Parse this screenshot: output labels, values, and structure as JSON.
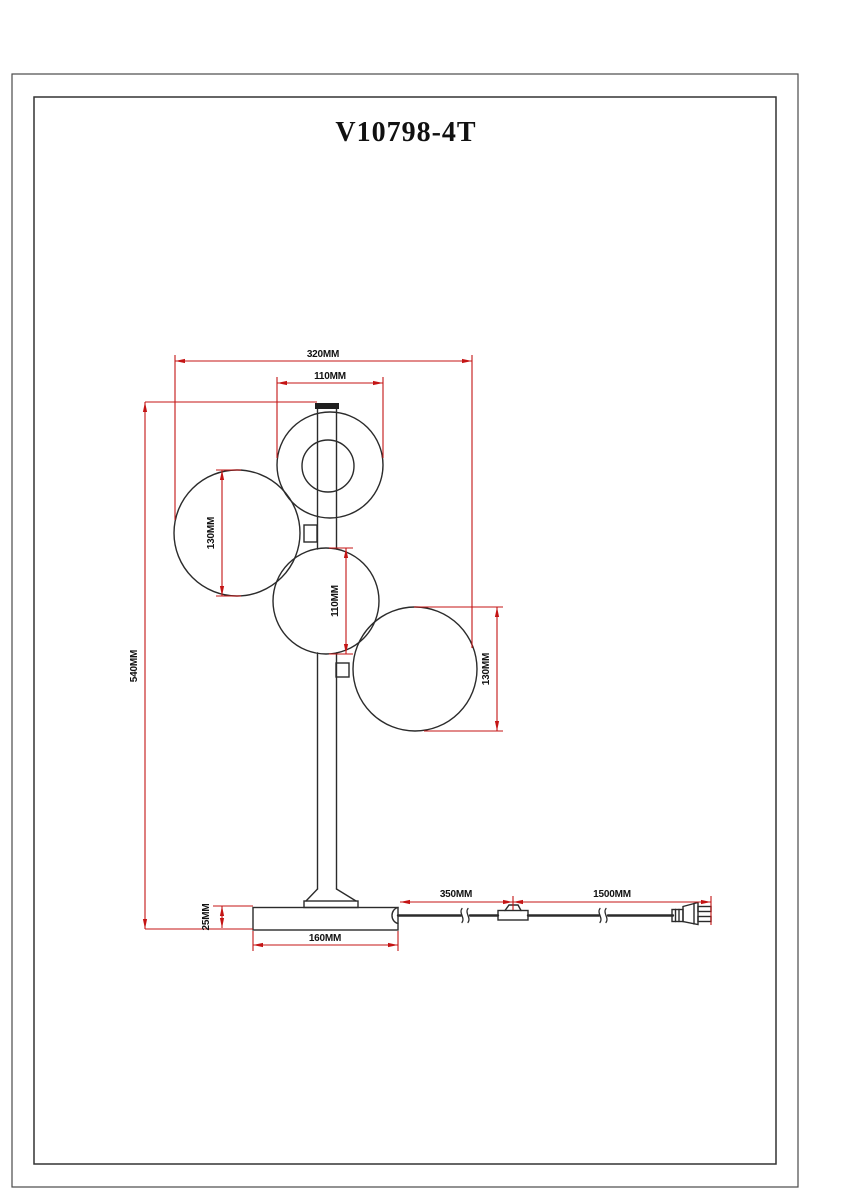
{
  "page": {
    "title": "V10798-4T"
  },
  "drawing": {
    "type": "technical-dimension-diagram",
    "subject": "four-globe table lamp",
    "unit": "MM",
    "line_color": "#2b2b2b",
    "dimension_color": "#c41414",
    "dimensions": {
      "overall_width": "320MM",
      "top_globe_diameter": "110MM",
      "overall_height": "540MM",
      "left_globe_diameter": "130MM",
      "middle_globe_diameter": "110MM",
      "right_globe_diameter": "130MM",
      "base_thickness": "25MM",
      "base_width": "160MM",
      "cord_base_to_switch": "350MM",
      "cord_switch_to_plug": "1500MM"
    }
  }
}
